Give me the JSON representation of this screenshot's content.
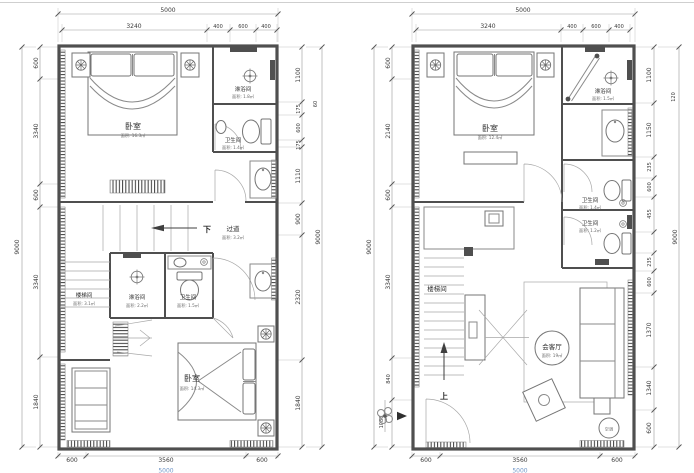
{
  "canvas": {
    "bg": "#ffffff",
    "wall_color": "#4f4f4f",
    "dim_text_color": "#3a3a3a",
    "accent_blue": "#7096c8"
  },
  "plans": {
    "left": {
      "dims": {
        "top_total": "5000",
        "top_segments": [
          "3240",
          "400",
          "600",
          "400"
        ],
        "left_total": "9000",
        "left_segments": [
          "600",
          "3340",
          "600",
          "3340",
          "1840"
        ],
        "right_total": "9000",
        "right_fragment": "60",
        "right_segments": [
          "1100",
          "175",
          "600",
          "175",
          "1110",
          "900",
          "2320",
          "1840"
        ],
        "bottom_total": "5000",
        "bottom_segments": [
          "600",
          "3560",
          "600"
        ]
      },
      "rooms": {
        "bedroom_top_label": "卧室",
        "bedroom_top_area": "面积: 16.3㎡",
        "shower_top_label": "淋浴间",
        "shower_top_area": "面积: 1.8㎡",
        "toilet_top_label": "卫生间",
        "toilet_top_area": "面积: 1.4㎡",
        "down_label": "下",
        "corridor_label": "过道",
        "corridor_area": "面积: 3.2㎡",
        "stair_label": "楼梯间",
        "stair_area": "面积: 3.1㎡",
        "shower_mid_label": "淋浴间",
        "shower_mid_area": "面积: 2.2㎡",
        "toilet_mid_label": "卫生间",
        "toilet_mid_area": "面积: 1.5㎡",
        "bedroom_bottom_label": "卧室",
        "bedroom_bottom_area": "面积: 14.3㎡"
      }
    },
    "right": {
      "dims": {
        "top_total": "5000",
        "top_segments": [
          "3240",
          "400",
          "600",
          "400"
        ],
        "left_total": "9000",
        "left_segments": [
          "600",
          "2140",
          "600",
          "3340",
          "840",
          "1080"
        ],
        "right_total": "9000",
        "right_fragment": "120",
        "right_segments": [
          "1100",
          "1150",
          "235",
          "600",
          "455",
          "235",
          "600",
          "1370",
          "1340",
          "600"
        ],
        "bottom_total": "5000",
        "bottom_segments": [
          "600",
          "3560",
          "600"
        ]
      },
      "rooms": {
        "bedroom_label": "卧室",
        "bedroom_area": "面积: 12.4㎡",
        "shower_label": "淋浴间",
        "shower_area": "面积: 1.5㎡",
        "toilet_upper_label": "卫生间",
        "toilet_upper_area": "面积: 1.4㎡",
        "toilet_lower_label": "卫生间",
        "toilet_lower_area": "面积: 1.2㎡",
        "stair_label": "楼梯间",
        "up_label": "上",
        "living_label": "会客厅",
        "living_area": "面积: 19㎡",
        "ac_label": "空调"
      }
    }
  }
}
